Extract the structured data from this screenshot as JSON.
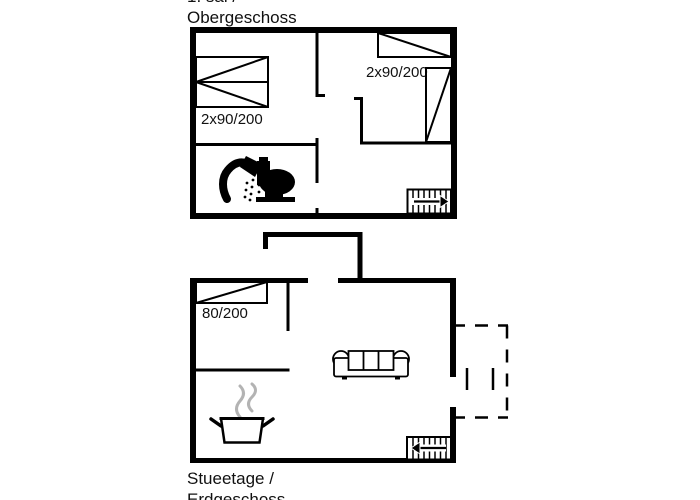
{
  "colors": {
    "background": "#ffffff",
    "line": "#000000",
    "text": "#111111",
    "steam": "#b3b3b3"
  },
  "upper_floor": {
    "title_line1": "1. sal /",
    "title_line2": "Obergeschoss",
    "left_bed_label": "2x90/200",
    "right_bed_label": "2x90/200"
  },
  "ground_floor": {
    "title_line1": "Stueetage /",
    "title_line2": "Erdgeschoss",
    "bed_label": "80/200"
  },
  "icons": {
    "shower": "shower-icon",
    "toilet": "toilet-icon",
    "stairs_upper": "stairs-icon-arrow-right",
    "stairs_ground": "stairs-icon-arrow-left",
    "sofa": "sofa-icon",
    "cooking_pot": "cooking-pot-icon",
    "terrace": "terrace-dashed-outline"
  }
}
